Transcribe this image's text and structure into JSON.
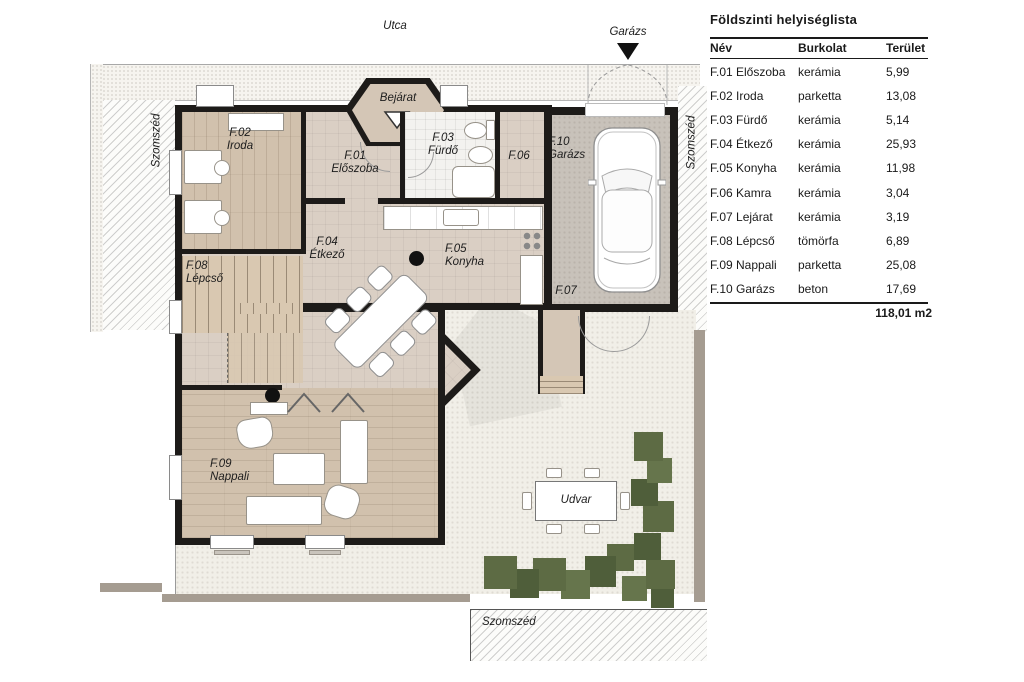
{
  "legend": {
    "title": "Földszinti helyiséglista",
    "columns": {
      "name": "Név",
      "flooring": "Burkolat",
      "area": "Terület"
    },
    "rows": [
      {
        "name": "F.01 Előszoba",
        "flooring": "kerámia",
        "area": "5,99"
      },
      {
        "name": "F.02 Iroda",
        "flooring": "parketta",
        "area": "13,08"
      },
      {
        "name": "F.03 Fürdő",
        "flooring": "kerámia",
        "area": "5,14"
      },
      {
        "name": "F.04 Étkező",
        "flooring": "kerámia",
        "area": "25,93"
      },
      {
        "name": "F.05 Konyha",
        "flooring": "kerámia",
        "area": "11,98"
      },
      {
        "name": "F.06 Kamra",
        "flooring": "kerámia",
        "area": "3,04"
      },
      {
        "name": "F.07 Lejárat",
        "flooring": "kerámia",
        "area": "3,19"
      },
      {
        "name": "F.08 Lépcső",
        "flooring": "tömörfa",
        "area": "6,89"
      },
      {
        "name": "F.09 Nappali",
        "flooring": "parketta",
        "area": "25,08"
      },
      {
        "name": "F.10 Garázs",
        "flooring": "beton",
        "area": "17,69"
      }
    ],
    "total": "118,01 m2"
  },
  "plan": {
    "labels": {
      "street": "Utca",
      "garage_entry": "Garázs",
      "entrance": "Bejárat",
      "neighbor_left": "Szomszéd",
      "neighbor_right": "Szomszéd",
      "neighbor_bottom": "Szomszéd",
      "courtyard": "Udvar"
    },
    "rooms": {
      "f01": {
        "id": "F.01",
        "name": "Előszoba"
      },
      "f02": {
        "id": "F.02",
        "name": "Iroda"
      },
      "f03": {
        "id": "F.03",
        "name": "Fürdő"
      },
      "f04": {
        "id": "F.04",
        "name": "Étkező"
      },
      "f05": {
        "id": "F.05",
        "name": "Konyha"
      },
      "f06": {
        "id": "F.06",
        "name": ""
      },
      "f07": {
        "id": "F.07",
        "name": ""
      },
      "f08": {
        "id": "F.08",
        "name": "Lépcső"
      },
      "f09": {
        "id": "F.09",
        "name": "Nappali"
      },
      "f10": {
        "id": "F.10",
        "name": "Garázs"
      }
    },
    "colors": {
      "wall": "#1d1b19",
      "parquet": "#d1c1ad",
      "ceramic": "#dacfc4",
      "tile_white": "#f3f2ef",
      "stairs_wood": "#d9c8b1",
      "garage_concrete": "#c8c2ba",
      "courtyard": "#f1efe8",
      "fence": "#a59c91",
      "bush_green": "#5d6b44",
      "porch": "#d4c6b6"
    }
  }
}
